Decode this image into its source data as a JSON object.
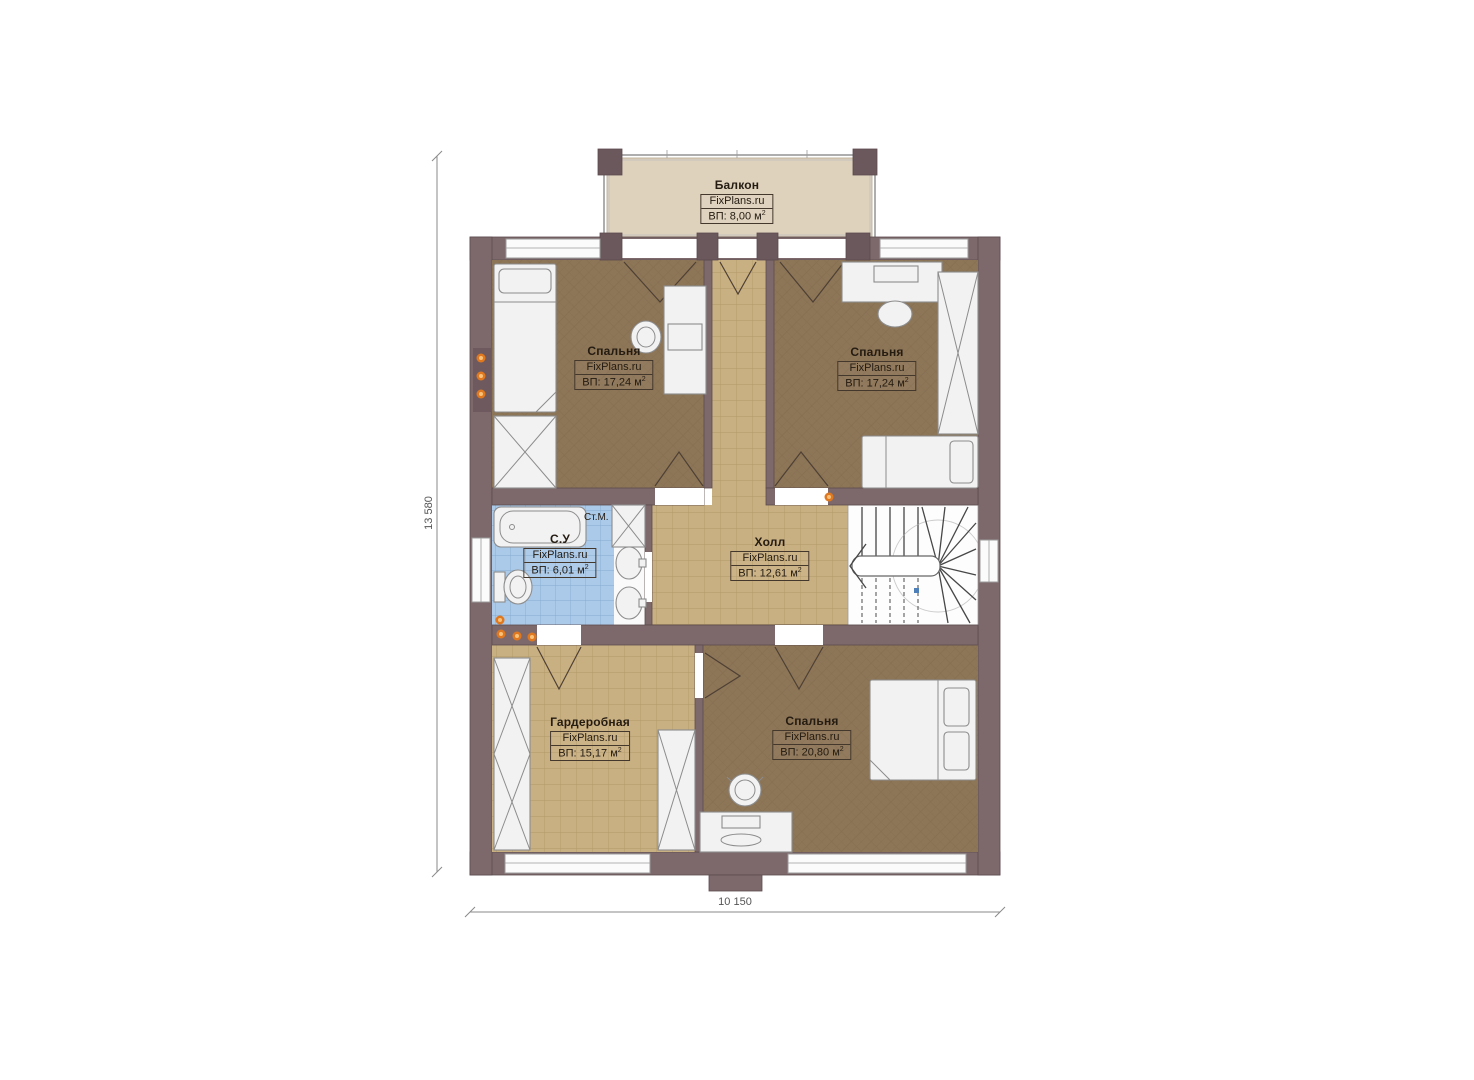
{
  "plan_title": "Floor plan — second floor",
  "rooms": [
    {
      "id": "balcony",
      "name": "Балкон",
      "brand": "FixPlans.ru",
      "area": "ВП: 8,00 м"
    },
    {
      "id": "bedroom-top-left",
      "name": "Спальня",
      "brand": "FixPlans.ru",
      "area": "ВП: 17,24 м"
    },
    {
      "id": "bedroom-top-right",
      "name": "Спальня",
      "brand": "FixPlans.ru",
      "area": "ВП: 17,24 м"
    },
    {
      "id": "bathroom",
      "name": "С.У",
      "brand": "FixPlans.ru",
      "area": "ВП: 6,01 м"
    },
    {
      "id": "hall",
      "name": "Холл",
      "brand": "FixPlans.ru",
      "area": "ВП: 12,61 м"
    },
    {
      "id": "wardrobe",
      "name": "Гардеробная",
      "brand": "FixPlans.ru",
      "area": "ВП: 15,17 м"
    },
    {
      "id": "bedroom-bottom",
      "name": "Спальня",
      "brand": "FixPlans.ru",
      "area": "ВП: 20,80 м"
    }
  ],
  "annotations": {
    "washing_machine": "Ст.М."
  },
  "dimensions": {
    "vertical": "13 580",
    "horizontal": "10 150"
  },
  "colors": {
    "wall": "#7d696c",
    "wallDark": "#6b585c",
    "wallLine": "#5c4b4e",
    "carpet": "#8d7557",
    "carpetLine": "#7a6347",
    "tile": "#c9b083",
    "tileLine": "#ab9260",
    "btile": "#abcaea",
    "btileLine": "#86aacd",
    "balconyFloor": "#ded2bd",
    "furniture": "#f2f2f2",
    "furnitureLine": "#8c8c8c",
    "accent": "#e07820",
    "text": "#241b11"
  }
}
